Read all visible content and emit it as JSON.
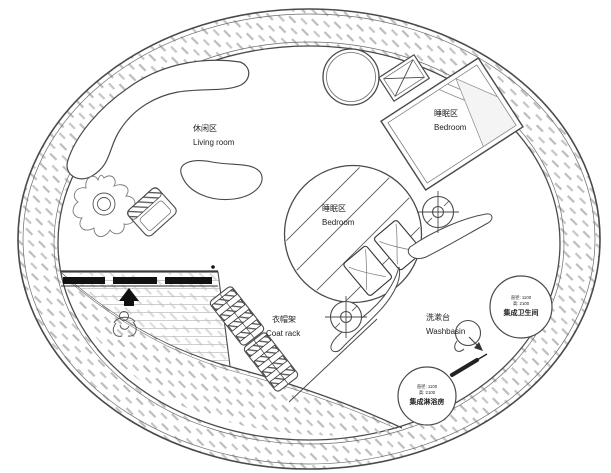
{
  "plan_title": "circular-tiny-house-floor-plan",
  "colors": {
    "line": "#4a4a4a",
    "hatch": "#bdbdbd",
    "deck_line": "#c9c9c9",
    "solid_black": "#111111",
    "text": "#222222",
    "background": "#ffffff"
  },
  "areas": {
    "living_room": {
      "zh": "休闲区",
      "en": "Living room"
    },
    "bedroom_upper": {
      "zh": "睡眠区",
      "en": "Bedroom"
    },
    "bedroom_center": {
      "zh": "睡眠区",
      "en": "Bedroom"
    },
    "coat_rack": {
      "zh": "衣帽架",
      "en": "Coat rack"
    },
    "washbasin": {
      "zh": "洗漱台",
      "en": "Washbasin"
    }
  },
  "pods": {
    "bathroom": {
      "name": "集成卫生间",
      "dim_diameter": "直径: 1100",
      "dim_height": "高: 2100"
    },
    "shower": {
      "name": "集成淋浴房",
      "dim_diameter": "直径: 1100",
      "dim_height": "高: 2100"
    }
  },
  "symbols": {
    "outer_wall": "hatched-ring-wall",
    "entry_deck": "hatched-entry-deck",
    "entry_arrow": "entry-direction-arrow",
    "person": "person-figure",
    "plant": "potted-plant",
    "sofa": "curved-sofa",
    "coffee_table": "kidney-coffee-table",
    "armchair": "armchair",
    "round_table": "round-table",
    "equipment_box": "crossed-box-equipment",
    "bed": "double-bed",
    "platform": "central-bed-platform",
    "pillows": "bed-pillows",
    "marker": "crosshair-target-marker",
    "basin": "round-basin-with-faucet",
    "windows": "window-wall-segments"
  }
}
